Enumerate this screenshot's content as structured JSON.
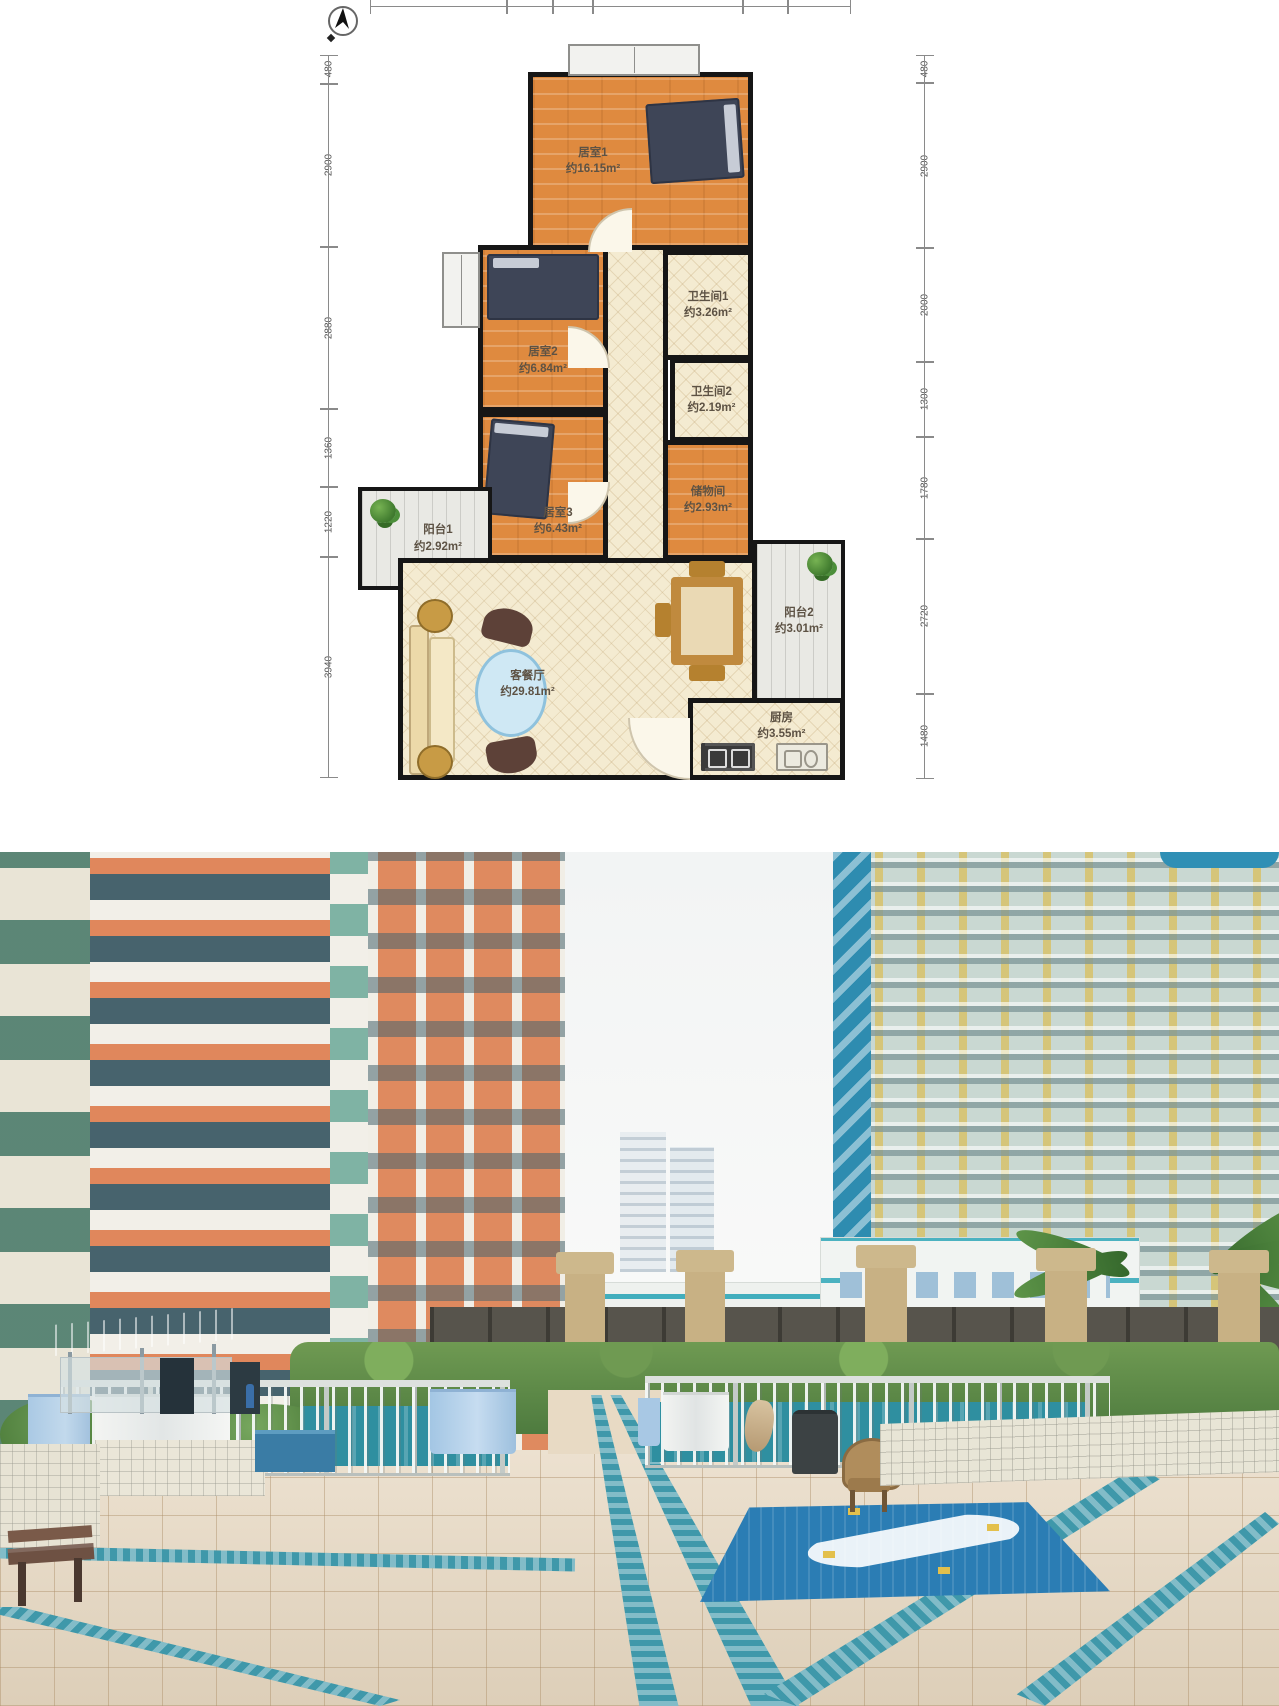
{
  "floorplan": {
    "compass_icon": "north-arrow",
    "dims_top": [
      "2060",
      "680",
      "580",
      "2249",
      "649",
      "940"
    ],
    "dims_left": [
      "480",
      "2900",
      "2880",
      "1360",
      "1220",
      "3940"
    ],
    "dims_right": [
      "480",
      "2900",
      "2000",
      "1300",
      "1780",
      "2720",
      "1480"
    ],
    "rooms": {
      "bedroom1": {
        "name": "居室1",
        "area": "约16.15m²"
      },
      "bath1": {
        "name": "卫生间1",
        "area": "约3.26m²"
      },
      "bedroom2": {
        "name": "居室2",
        "area": "约6.84m²"
      },
      "bath2": {
        "name": "卫生间2",
        "area": "约2.19m²"
      },
      "storage": {
        "name": "储物间",
        "area": "约2.93m²"
      },
      "balcony1": {
        "name": "阳台1",
        "area": "约2.92m²"
      },
      "bedroom3": {
        "name": "居室3",
        "area": "约6.43m²"
      },
      "living": {
        "name": "客餐厅",
        "area": "约29.81m²"
      },
      "balcony2": {
        "name": "阳台2",
        "area": "约3.01m²"
      },
      "kitchen": {
        "name": "厨房",
        "area": "约3.55m²"
      }
    },
    "colors": {
      "wood_floor": "#df8a3f",
      "tile_floor": "#f4ebd1",
      "wall": "#161616",
      "bed": "#3e4557"
    }
  },
  "photo": {
    "colors": {
      "building_orange": "#e0885c",
      "balcony_white": "#f2efe8",
      "window_glass_green": "#47636d",
      "tower_mullion_yellow": "#d6c475",
      "tower_glass": "#c9d8d2",
      "corner_glass_blue": "#2e8cb0",
      "midrise_stripe_teal": "#2ea7b8",
      "plaza_tile": "#e6d7c0",
      "drain_teal": "#3f98aa",
      "pool_water": "#2f8fa0",
      "mosaic_blue": "#2b7db4",
      "hedge_green": "#5d8a46",
      "pillar_tan": "#c8b184",
      "canopy_blue": "#4a7fb5",
      "towel_blue": "#aac9e4",
      "bench_brown": "#6e5143"
    }
  }
}
